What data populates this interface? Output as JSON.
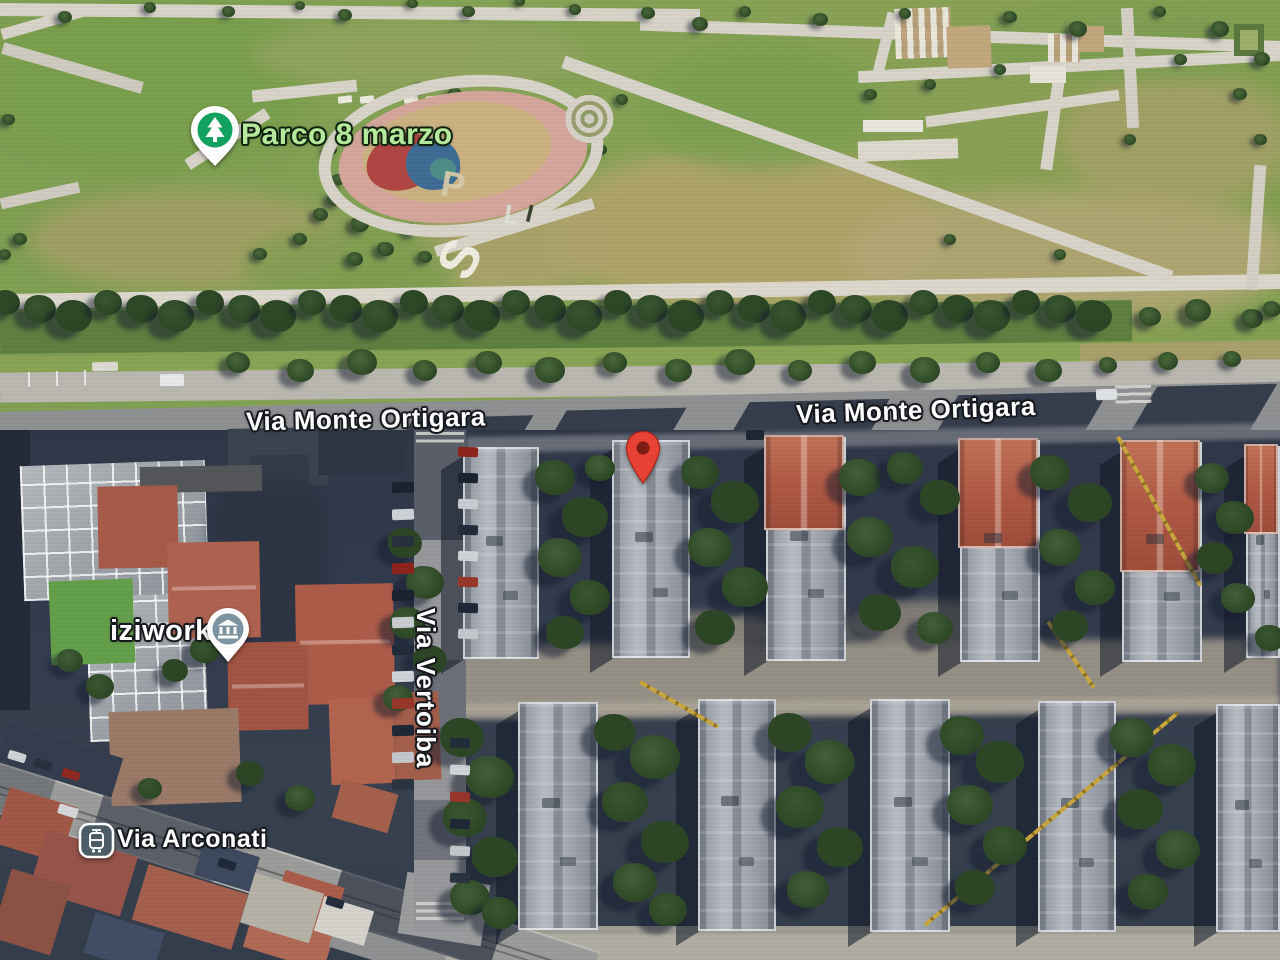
{
  "map": {
    "view_type": "satellite-aerial",
    "poi_labels": [
      {
        "text": "Parco 8 marzo",
        "type": "park",
        "icon": "tree-pin",
        "text_color": "#b7ec9e",
        "pin_color": "#12a361"
      },
      {
        "text": "iziwork",
        "type": "business",
        "icon": "museum-pin",
        "text_color": "#ffffff",
        "pin_color": "#7e95a3"
      }
    ],
    "street_labels": [
      {
        "text": "Via Monte Ortigara",
        "position": "west"
      },
      {
        "text": "Via Monte Ortigara",
        "position": "east"
      },
      {
        "text": "Via Vertoiba",
        "orientation": "vertical"
      },
      {
        "text": "Via Arconati",
        "icon": "tram-badge",
        "badge_color": "#4c5d68"
      }
    ],
    "marker": {
      "icon": "red-location-pin",
      "color": "#ea4335",
      "inner_color": "#7e1d14"
    },
    "ground_letters": [
      {
        "char": "P"
      },
      {
        "char": "L"
      },
      {
        "char": "I"
      },
      {
        "char": "S"
      }
    ]
  }
}
